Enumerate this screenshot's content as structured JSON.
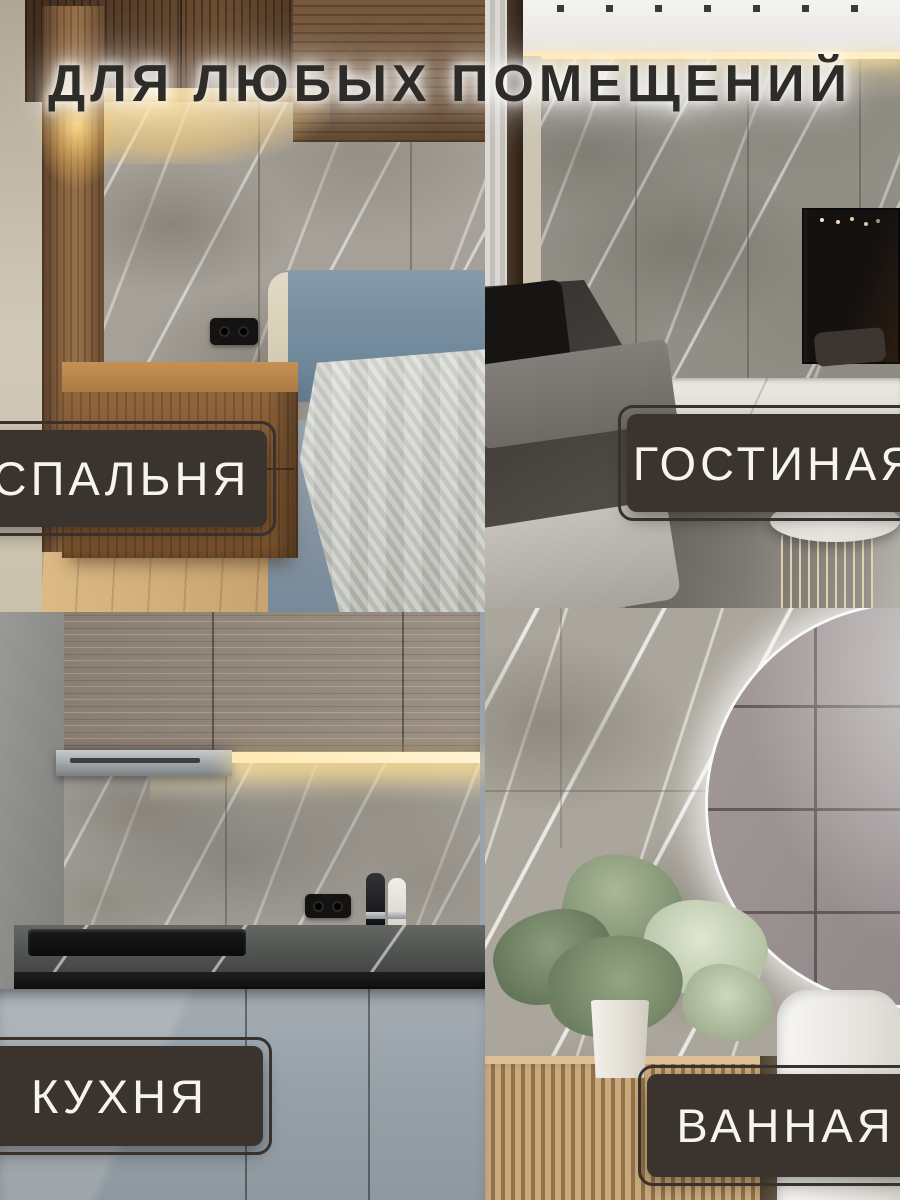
{
  "title": "ДЛЯ ЛЮБЫХ ПОМЕЩЕНИЙ",
  "sections": [
    {
      "id": "bedroom",
      "label": "СПАЛЬНЯ"
    },
    {
      "id": "living-room",
      "label": "ГОСТИНАЯ"
    },
    {
      "id": "kitchen",
      "label": "КУХНЯ"
    },
    {
      "id": "bathroom",
      "label": "ВАННАЯ"
    }
  ],
  "palette": {
    "label_background": "#3b332d",
    "label_border": "#39312b",
    "label_text": "#f6f4ef",
    "title_text": "#2e2c29",
    "title_glow": "#ffffff",
    "marble_base": "#a6a198",
    "marble_vein": "#ffffff"
  }
}
